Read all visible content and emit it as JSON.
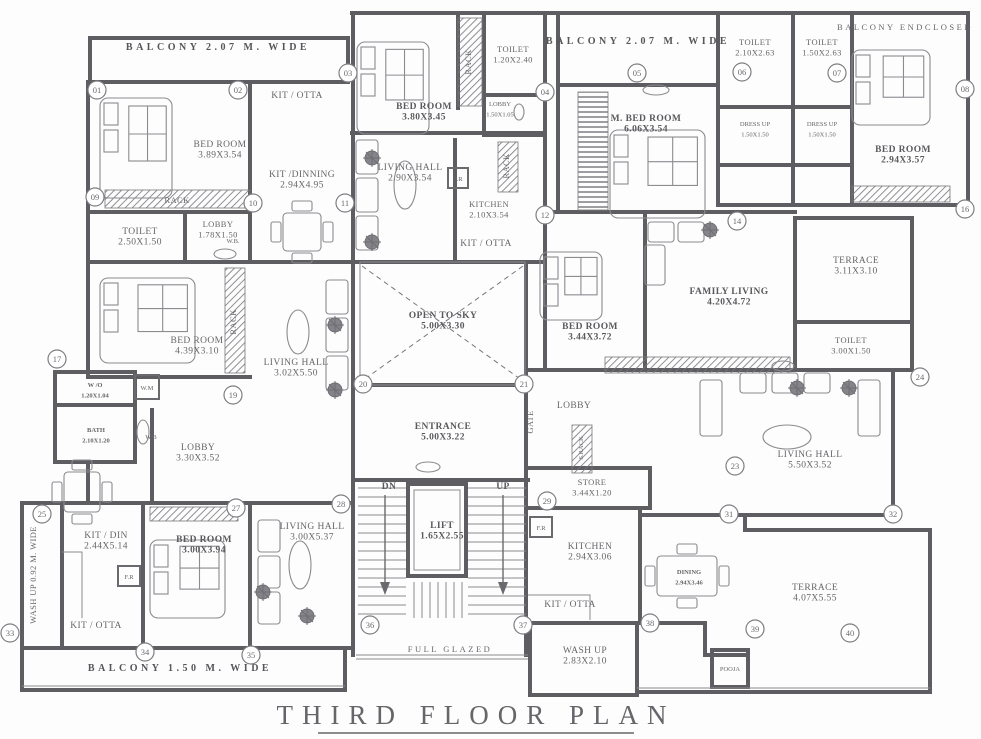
{
  "title": {
    "text": "THIRD FLOOR PLAN"
  },
  "colors": {
    "ink": "#5f5f63",
    "background": "#fdfdfd"
  },
  "plan": {
    "labels": [
      {
        "id": "balcony-top-left",
        "text": "BALCONY 2.07 M. WIDE",
        "x": 218,
        "y": 50,
        "cls": "banner"
      },
      {
        "id": "balcony-top-mid",
        "text": "BALCONY 2.07 M. WIDE",
        "x": 638,
        "y": 44,
        "cls": "banner"
      },
      {
        "id": "balcony-enclosed",
        "text": "BALCONY ENDCLOSED",
        "x": 905,
        "y": 30,
        "cls": "spaced-sm"
      },
      {
        "id": "toilet-top-1",
        "text": "TOILET",
        "dim": "2.10X2.63",
        "x": 755,
        "y": 45,
        "cls": "small"
      },
      {
        "id": "toilet-top-2",
        "text": "TOILET",
        "dim": "1.50X2.63",
        "x": 822,
        "y": 45,
        "cls": "small"
      },
      {
        "id": "bed-room-top-left",
        "text": "BED ROOM",
        "dim": "3.89X3.54",
        "x": 220,
        "y": 147
      },
      {
        "id": "kit-otta-top-left",
        "text": "KIT / OTTA",
        "x": 297,
        "y": 98
      },
      {
        "id": "kit-dinning",
        "text": "KIT /DINNING",
        "dim": "2.94X4.95",
        "x": 302,
        "y": 177
      },
      {
        "id": "rack-top-left",
        "text": "RACK",
        "x": 177,
        "y": 203,
        "cls": "small"
      },
      {
        "id": "bed-room-top-mid",
        "text": "BED ROOM",
        "dim": "3.80X3.45",
        "x": 424,
        "y": 109,
        "cls": "bold"
      },
      {
        "id": "rack-vert-1",
        "text": "RACK",
        "x": 471,
        "y": 62,
        "cls": "small",
        "rot": true
      },
      {
        "id": "toilet-top-mid",
        "text": "TOILET",
        "dim": "1.20X2.40",
        "x": 513,
        "y": 52,
        "cls": "small"
      },
      {
        "id": "lobby-small",
        "text": "LOBBY",
        "dim": "1.50X1.05",
        "x": 500,
        "y": 106,
        "cls": "tiny"
      },
      {
        "id": "living-hall-top-mid",
        "text": "LIVING HALL",
        "dim": "2.90X3.54",
        "x": 410,
        "y": 170
      },
      {
        "id": "fr-1",
        "text": "F.R",
        "x": 458,
        "y": 181,
        "cls": "tiny"
      },
      {
        "id": "kitchen-top-mid",
        "text": "KITCHEN",
        "dim": "2.10X3.54",
        "x": 489,
        "y": 207,
        "cls": "small"
      },
      {
        "id": "rack-vert-2",
        "text": "RACK",
        "x": 509,
        "y": 166,
        "cls": "small",
        "rot": true
      },
      {
        "id": "kit-otta-mid",
        "text": "KIT / OTTA",
        "x": 486,
        "y": 246
      },
      {
        "id": "m-bed-room",
        "text": "M. BED ROOM",
        "dim": "6.06X3.54",
        "x": 646,
        "y": 121,
        "cls": "bold"
      },
      {
        "id": "toilet-left",
        "text": "TOILET",
        "dim": "2.50X1.50",
        "x": 140,
        "y": 234
      },
      {
        "id": "lobby-left",
        "text": "LOBBY",
        "dim": "1.78X1.50",
        "x": 218,
        "y": 227,
        "cls": "small"
      },
      {
        "id": "wb-lobby",
        "text": "W.B.",
        "x": 233,
        "y": 243,
        "cls": "tiny"
      },
      {
        "id": "bed-room-mid-left",
        "text": "BED ROOM",
        "dim": "4.39X3.10",
        "x": 197,
        "y": 343
      },
      {
        "id": "rack-vert-3",
        "text": "RACK",
        "x": 236,
        "y": 322,
        "cls": "small",
        "rot": true
      },
      {
        "id": "living-hall-mid-left",
        "text": "LIVING HALL",
        "dim": "3.02X5.50",
        "x": 296,
        "y": 365
      },
      {
        "id": "open-to-sky",
        "text": "OPEN TO SKY",
        "dim": "5.00X3.30",
        "x": 443,
        "y": 318,
        "cls": "bold"
      },
      {
        "id": "bed-room-mid",
        "text": "BED ROOM",
        "dim": "3.44X3.72",
        "x": 590,
        "y": 329,
        "cls": "bold"
      },
      {
        "id": "family-living",
        "text": "FAMILY LIVING",
        "dim": "4.20X4.72",
        "x": 729,
        "y": 294,
        "cls": "bold"
      },
      {
        "id": "dress-up-1",
        "text": "DRESS UP",
        "dim": "1.50X1.50",
        "x": 755,
        "y": 126,
        "cls": "tiny"
      },
      {
        "id": "dress-up-2",
        "text": "DRESS UP",
        "dim": "1.50X1.50",
        "x": 822,
        "y": 126,
        "cls": "tiny"
      },
      {
        "id": "bed-room-top-right",
        "text": "BED ROOM",
        "dim": "2.94X3.57",
        "x": 903,
        "y": 152,
        "cls": "bold"
      },
      {
        "id": "terrace-right",
        "text": "TERRACE",
        "dim": "3.11X3.10",
        "x": 856,
        "y": 263
      },
      {
        "id": "toilet-right",
        "text": "TOILET",
        "dim": "3.00X1.50",
        "x": 851,
        "y": 343,
        "cls": "small"
      },
      {
        "id": "entrance",
        "text": "ENTRANCE",
        "dim": "5.00X3.22",
        "x": 443,
        "y": 429,
        "cls": "bold"
      },
      {
        "id": "lobby-right",
        "text": "LOBBY",
        "x": 574,
        "y": 408
      },
      {
        "id": "gate",
        "text": "GATE",
        "x": 533,
        "y": 422,
        "cls": "small",
        "rot": true
      },
      {
        "id": "s-rack",
        "text": "S.RACK",
        "x": 583,
        "y": 448,
        "cls": "tiny",
        "rot": true
      },
      {
        "id": "store",
        "text": "STORE",
        "dim": "3.44X1.20",
        "x": 592,
        "y": 485,
        "cls": "small"
      },
      {
        "id": "kitchen-right",
        "text": "KITCHEN",
        "dim": "2.94X3.06",
        "x": 590,
        "y": 549
      },
      {
        "id": "kit-otta-right",
        "text": "KIT / OTTA",
        "x": 570,
        "y": 607
      },
      {
        "id": "dining",
        "text": "DINING",
        "dim": "2.94X3.46",
        "x": 689,
        "y": 574,
        "cls": "tinybold"
      },
      {
        "id": "wash-up-right",
        "text": "WASH UP",
        "dim": "2.83X2.10",
        "x": 585,
        "y": 653
      },
      {
        "id": "pooja",
        "text": "POOJA",
        "x": 730,
        "y": 671,
        "cls": "tiny"
      },
      {
        "id": "living-hall-right",
        "text": "LIVING HALL",
        "dim": "5.50X3.52",
        "x": 810,
        "y": 457
      },
      {
        "id": "terrace-bottom",
        "text": "TERRACE",
        "dim": "4.07X5.55",
        "x": 815,
        "y": 590
      },
      {
        "id": "w-o",
        "text": "W /O",
        "dim": "1.20X1.04",
        "x": 95,
        "y": 387,
        "cls": "tinybold"
      },
      {
        "id": "w-m",
        "text": "W.M",
        "x": 147,
        "y": 390,
        "cls": "tiny"
      },
      {
        "id": "bath",
        "text": "BATH",
        "dim": "2.10X1.20",
        "x": 96,
        "y": 432,
        "cls": "tinybold"
      },
      {
        "id": "wb-bath",
        "text": "W.B",
        "x": 151,
        "y": 439,
        "cls": "tiny"
      },
      {
        "id": "lobby-bottom-left",
        "text": "LOBBY",
        "dim": "3.30X3.52",
        "x": 198,
        "y": 450
      },
      {
        "id": "kit-din",
        "text": "KIT / DIN",
        "dim": "2.44X5.14",
        "x": 106,
        "y": 538
      },
      {
        "id": "fr-2",
        "text": "F.R",
        "x": 129,
        "y": 579,
        "cls": "tiny"
      },
      {
        "id": "kit-otta-bottom-left",
        "text": "KIT / OTTA",
        "x": 96,
        "y": 628
      },
      {
        "id": "bed-room-bottom-left",
        "text": "BED ROOM",
        "dim": "3.00X3.94",
        "x": 204,
        "y": 542,
        "cls": "bold"
      },
      {
        "id": "living-hall-bottom-left",
        "text": "LIVING HALL",
        "dim": "3.00X5.37",
        "x": 312,
        "y": 529
      },
      {
        "id": "wash-up-strip",
        "text": "WASH UP 0.92 M. WIDE",
        "x": 36,
        "y": 575,
        "cls": "small",
        "rot": true
      },
      {
        "id": "balcony-bottom",
        "text": "BALCONY 1.50 M. WIDE",
        "x": 180,
        "y": 671,
        "cls": "banner"
      },
      {
        "id": "dn",
        "text": "DN",
        "x": 389,
        "y": 489,
        "cls": "bold"
      },
      {
        "id": "up",
        "text": "UP",
        "x": 503,
        "y": 489,
        "cls": "bold"
      },
      {
        "id": "lift",
        "text": "LIFT",
        "dim": "1.65X2.55",
        "x": 442,
        "y": 528,
        "cls": "bold"
      },
      {
        "id": "full-glazed",
        "text": "FULL GLAZED",
        "x": 450,
        "y": 652,
        "cls": "spaced-sm"
      },
      {
        "id": "fr-3",
        "text": "F.R",
        "x": 541,
        "y": 530,
        "cls": "tiny"
      }
    ],
    "markers": [
      {
        "n": "01",
        "x": 97,
        "y": 90
      },
      {
        "n": "02",
        "x": 238,
        "y": 90
      },
      {
        "n": "03",
        "x": 348,
        "y": 73
      },
      {
        "n": "04",
        "x": 545,
        "y": 92
      },
      {
        "n": "05",
        "x": 637,
        "y": 73
      },
      {
        "n": "06",
        "x": 742,
        "y": 72
      },
      {
        "n": "07",
        "x": 837,
        "y": 73
      },
      {
        "n": "08",
        "x": 965,
        "y": 89
      },
      {
        "n": "09",
        "x": 95,
        "y": 197
      },
      {
        "n": "10",
        "x": 253,
        "y": 203
      },
      {
        "n": "11",
        "x": 345,
        "y": 203
      },
      {
        "n": "12",
        "x": 545,
        "y": 215
      },
      {
        "n": "14",
        "x": 737,
        "y": 221
      },
      {
        "n": "16",
        "x": 965,
        "y": 209
      },
      {
        "n": "17",
        "x": 57,
        "y": 359
      },
      {
        "n": "19",
        "x": 233,
        "y": 395
      },
      {
        "n": "20",
        "x": 363,
        "y": 384
      },
      {
        "n": "21",
        "x": 524,
        "y": 384
      },
      {
        "n": "23",
        "x": 735,
        "y": 466
      },
      {
        "n": "24",
        "x": 920,
        "y": 377
      },
      {
        "n": "25",
        "x": 42,
        "y": 514
      },
      {
        "n": "27",
        "x": 236,
        "y": 508
      },
      {
        "n": "28",
        "x": 341,
        "y": 504
      },
      {
        "n": "29",
        "x": 547,
        "y": 501
      },
      {
        "n": "31",
        "x": 729,
        "y": 514
      },
      {
        "n": "32",
        "x": 893,
        "y": 514
      },
      {
        "n": "33",
        "x": 10,
        "y": 633
      },
      {
        "n": "34",
        "x": 145,
        "y": 652
      },
      {
        "n": "35",
        "x": 251,
        "y": 655
      },
      {
        "n": "36",
        "x": 370,
        "y": 625
      },
      {
        "n": "37",
        "x": 523,
        "y": 625
      },
      {
        "n": "38",
        "x": 650,
        "y": 623
      },
      {
        "n": "39",
        "x": 755,
        "y": 629
      },
      {
        "n": "40",
        "x": 850,
        "y": 633
      }
    ]
  }
}
